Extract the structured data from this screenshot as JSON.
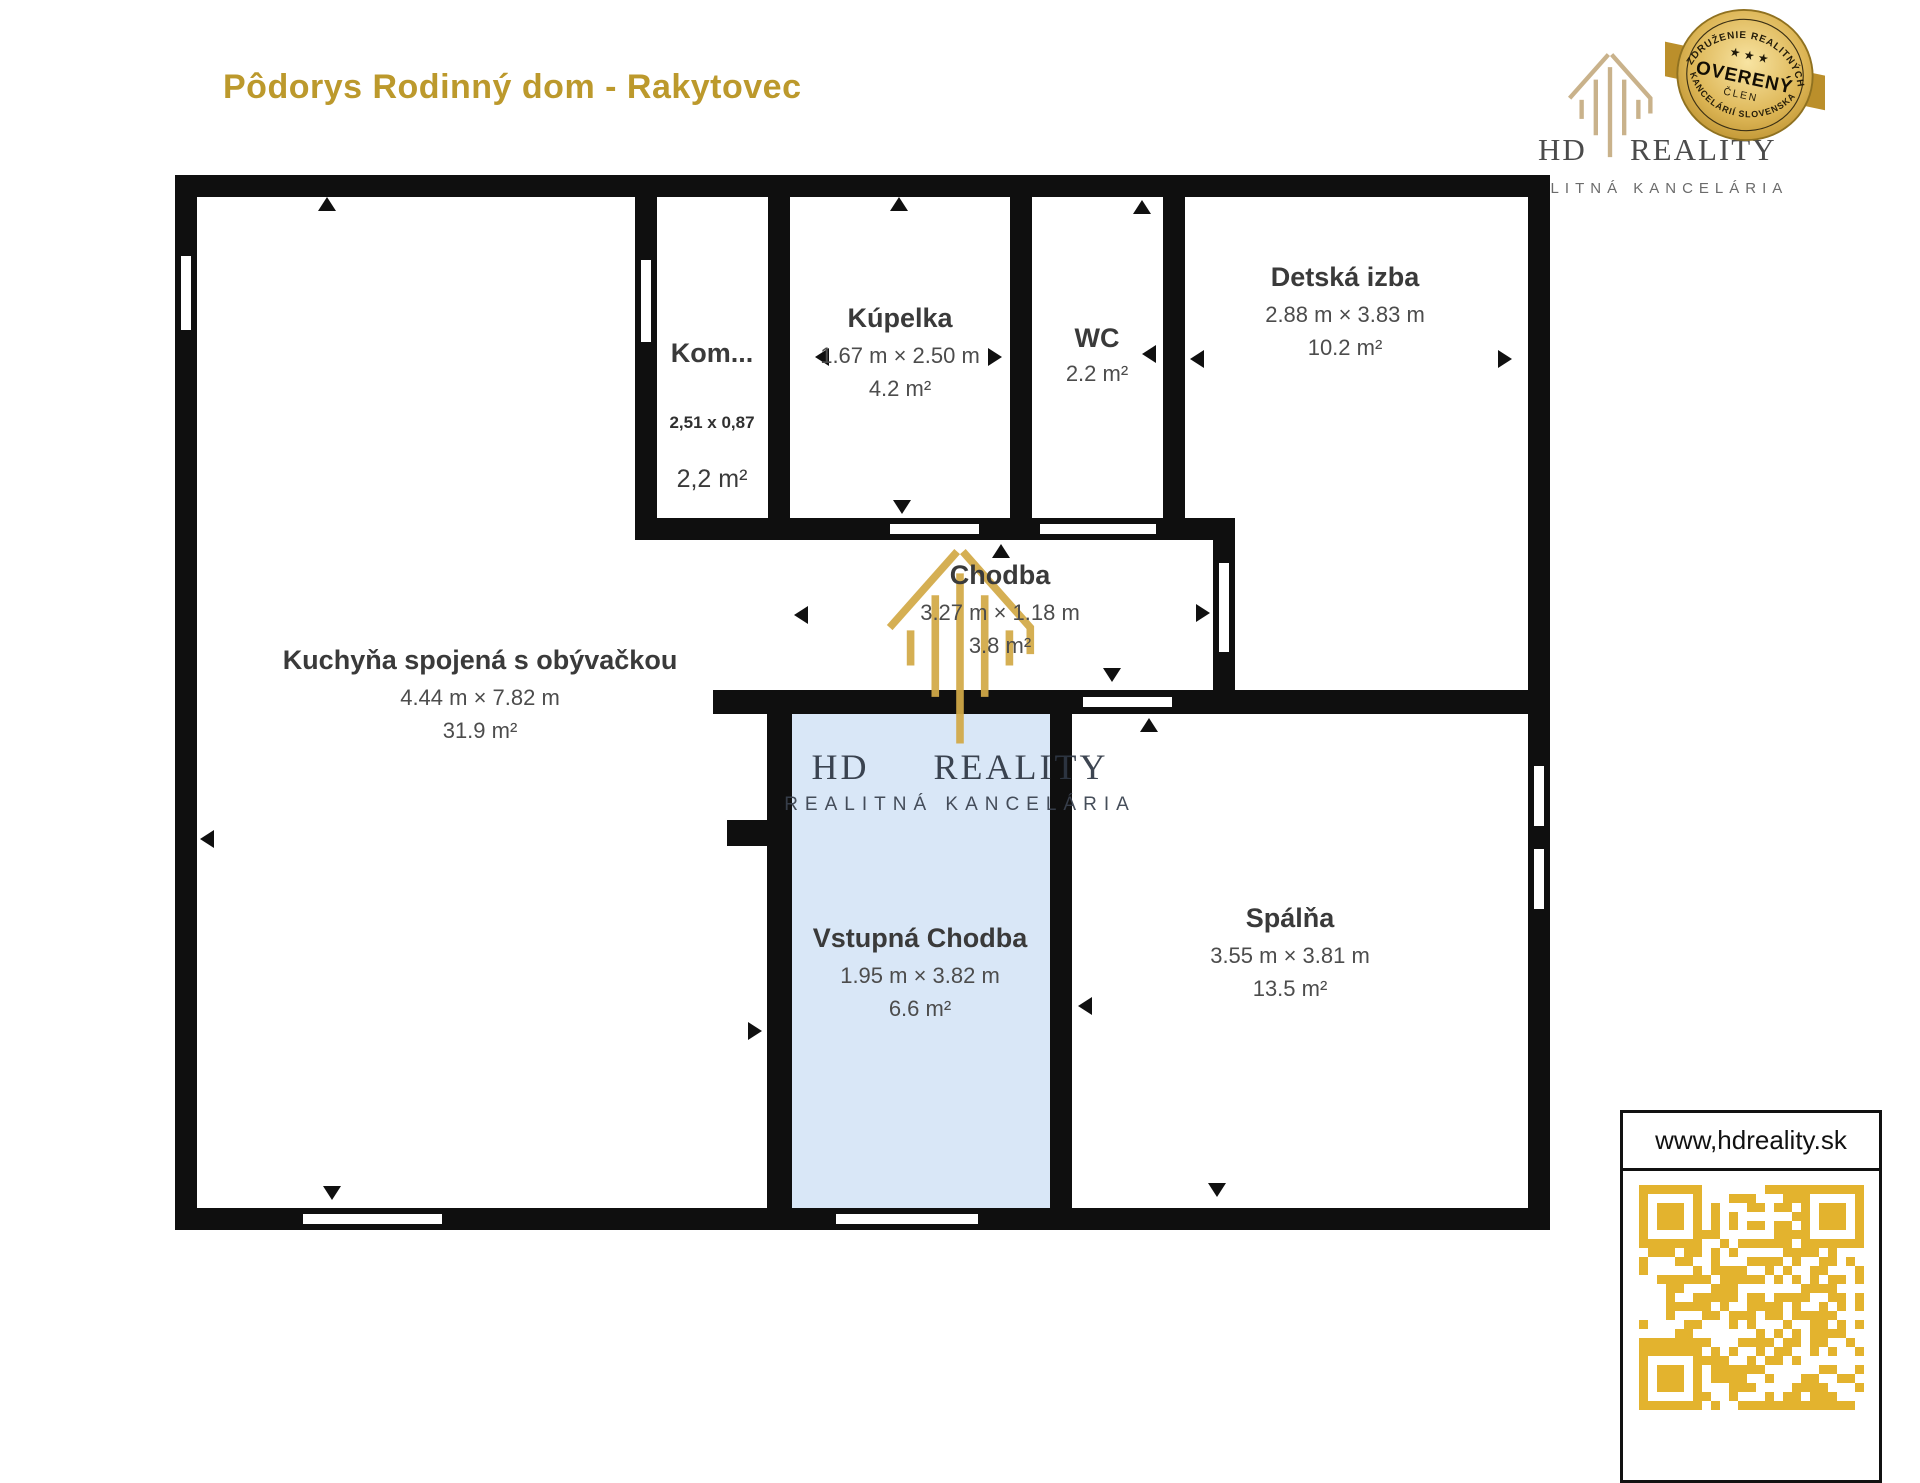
{
  "title": "Pôdorys Rodinný dom - Rakytovec",
  "logo": {
    "name_left": "HD",
    "name_right": "REALITY",
    "subtitle": "REALITNÁ KANCELÁRIA",
    "badge": {
      "top_text": "ZDRUŽENIE REALITNÝCH",
      "stars": "★ ★ ★",
      "main": "OVERENÝ",
      "sub": "ČLEN",
      "bottom_text": "KANCELÁRIÍ SLOVENSKA"
    }
  },
  "watermark": {
    "name_left": "HD",
    "name_right": "REALITY",
    "subtitle": "REALITNÁ KANCELÁRIA"
  },
  "rooms": [
    {
      "name": "Kuchyňa spojená s obývačkou",
      "dims": "4.44 m × 7.82 m",
      "area": "31.9 m²"
    },
    {
      "name": "Kom...",
      "dims": "2,51 x 0,87",
      "area": "2,2 m²"
    },
    {
      "name": "Kúpelka",
      "dims": "1.67 m × 2.50 m",
      "area": "4.2 m²"
    },
    {
      "name": "WC",
      "dims": "",
      "area": "2.2 m²"
    },
    {
      "name": "Detská izba",
      "dims": "2.88 m × 3.83 m",
      "area": "10.2 m²"
    },
    {
      "name": "Chodba",
      "dims": "3.27 m × 1.18 m",
      "area": "3.8 m²"
    },
    {
      "name": "Vstupná Chodba",
      "dims": "1.95 m × 3.82 m",
      "area": "6.6 m²"
    },
    {
      "name": "Spálňa",
      "dims": "3.55 m × 3.81 m",
      "area": "13.5 m²"
    }
  ],
  "footer": {
    "website": "www,hdreality.sk"
  },
  "colors": {
    "accent_gold": "#bc992c",
    "logo_tan": "#c9b28b",
    "watermark_gold": "#d2a947",
    "qr_gold": "#e3b32e",
    "entry_room_blue": "#d9e7f7",
    "wall_black": "#0f0f0f"
  }
}
